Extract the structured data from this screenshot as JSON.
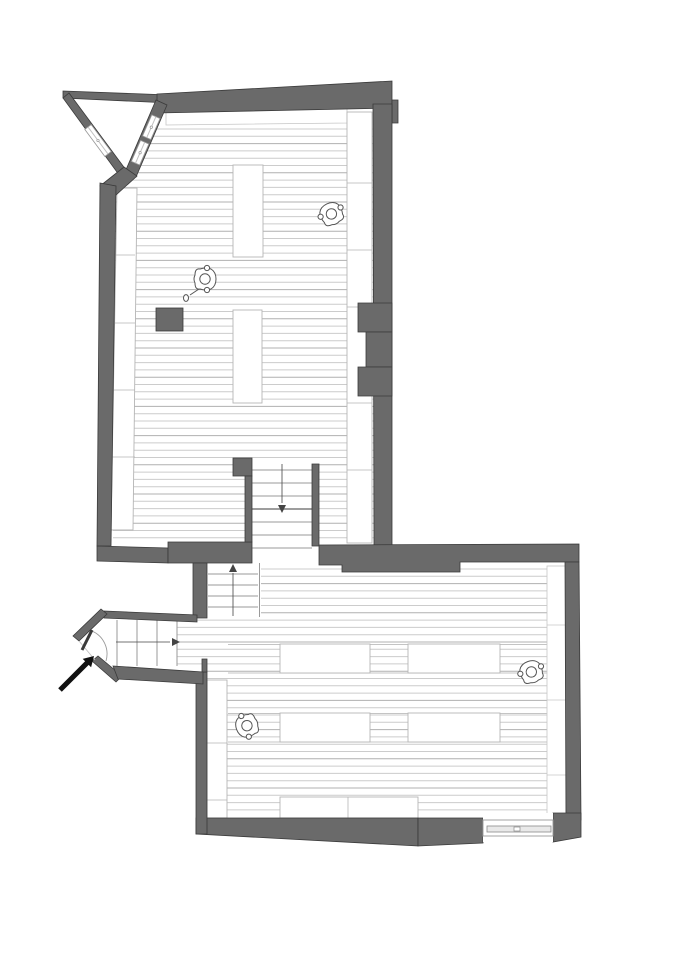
{
  "document": {
    "kind": "architectural floor plan drawing",
    "visible_text": "",
    "orientation": "plan view, two halls connected by staircases, entrance at lower left"
  },
  "canvas": {
    "width": 679,
    "height": 960,
    "background": "#ffffff"
  },
  "colors": {
    "wall_fill": "#6a6a6a",
    "wall_outline": "#3a3a3a",
    "board_line": "#cccccc",
    "board_line_dark": "#b0b0b0",
    "tread_line": "#9a9a9a",
    "tread_line_dark": "#7d7d7d",
    "walk_line": "#444444",
    "furniture_outline": "#b5b5b5",
    "figure_outline": "#555555",
    "arrow_black": "#111111",
    "window_frame": "#9a9a9a",
    "glass_fill": "#e9e9e9"
  },
  "floor_boards": {
    "upper_hall": {
      "x0": 106,
      "x1": 376,
      "y_start": 129,
      "y_end": 541,
      "spacing": 7.3
    },
    "lower_hall": {
      "x0": 172,
      "x1": 570,
      "y_start": 569,
      "y_end": 816,
      "spacing": 7.3
    }
  },
  "stairs": {
    "main": {
      "tread_x0": 252,
      "tread_x1": 312,
      "treads_y": [
        470,
        483,
        496,
        509,
        522,
        535,
        548
      ],
      "landing_line_y": 509,
      "walk_line": {
        "x": 282,
        "y0": 464,
        "y1": 503
      },
      "arrow": "down"
    },
    "small": {
      "tread_x0": 208,
      "tread_x1": 258,
      "treads_y": [
        574,
        585,
        596,
        607
      ],
      "side_line_x": 259.5,
      "side_line_y0": 563,
      "side_line_y1": 617,
      "walk_line": {
        "x": 233,
        "y0": 616,
        "y1": 573
      },
      "arrow": "up"
    },
    "entry": {
      "treads_x": [
        117,
        137,
        157
      ],
      "tread_y0": 620,
      "tread_y1": 666,
      "edge_line_x": 177,
      "walk_line": {
        "y": 642,
        "x0": 116,
        "x1": 170
      },
      "arrow": "right"
    }
  },
  "furniture": {
    "upper_tables": [
      {
        "x": 233,
        "y": 165,
        "w": 30,
        "h": 92
      },
      {
        "x": 233,
        "y": 310,
        "w": 29,
        "h": 93
      }
    ],
    "stove": {
      "x": 156,
      "y": 308,
      "w": 27,
      "h": 23
    },
    "upper_left_bench": {
      "points": "117,188 137,188 133,530 111,530",
      "dividers_y": [
        255,
        323,
        390,
        457
      ]
    },
    "upper_right_bench": {
      "x": 347,
      "y": 112,
      "w": 25,
      "h": 431,
      "dividers_y": [
        183,
        250,
        307,
        403,
        470
      ]
    },
    "upper_top_strip": {
      "points": "166,106 347,104 347,123 166,125"
    },
    "lower_tables": [
      {
        "x": 280,
        "y": 644,
        "w": 90,
        "h": 29
      },
      {
        "x": 408,
        "y": 644,
        "w": 92,
        "h": 29
      },
      {
        "x": 280,
        "y": 713,
        "w": 90,
        "h": 29
      },
      {
        "x": 408,
        "y": 713,
        "w": 92,
        "h": 29
      }
    ],
    "row_bands": [
      {
        "x0": 228,
        "x1": 547,
        "y0": 644.5,
        "y1": 673
      },
      {
        "x0": 228,
        "x1": 547,
        "y0": 713.5,
        "y1": 742
      }
    ],
    "lower_bottom_bench": {
      "x": 280,
      "y": 797,
      "w": 138,
      "h": 21,
      "divider_x": 348
    },
    "lower_left_bench": {
      "x": 207,
      "y": 680,
      "w": 20,
      "h": 138,
      "dividers_y": [
        743,
        800
      ]
    },
    "lower_right_strip": {
      "x": 547,
      "y": 566,
      "w": 19,
      "h": 250,
      "dividers_y": [
        625,
        700,
        775
      ]
    }
  },
  "figures": [
    {
      "x": 331,
      "y": 213,
      "rot": 155,
      "extended_arm": false
    },
    {
      "x": 206,
      "y": 279,
      "rot": -90,
      "extended_arm": true
    },
    {
      "x": 531,
      "y": 671,
      "rot": 160,
      "extended_arm": false
    },
    {
      "x": 246,
      "y": 726,
      "rot": 70,
      "extended_arm": false
    }
  ],
  "angled_windows": [
    {
      "points": "84.8,129.4 91.2,124.6 111.2,151.6 104.8,156.4",
      "line": [
        88,
        127,
        108,
        154
      ]
    },
    {
      "points": "160,118.5 151.8,114.9 142.6,135.9 150.8,139.5",
      "line": [
        155.9,
        116.7,
        146.7,
        137.7
      ]
    },
    {
      "points": "148.8,144 140.6,140.4 131.4,161.4 139.6,165",
      "line": [
        144.7,
        142.2,
        135.5,
        163.2
      ]
    }
  ],
  "bottom_window": {
    "frame": [
      483,
      820,
      553,
      836
    ],
    "glazing": [
      487,
      826,
      551,
      832
    ],
    "handle": [
      514,
      827,
      520,
      831
    ]
  },
  "entrance_door": {
    "leaf": [
      92,
      630,
      82,
      650
    ],
    "arc": "M92,631 A25,25 0 0 1 106,661",
    "threshold": [
      79,
      641,
      95,
      660
    ]
  },
  "entrance_arrow": {
    "points": "58.2,688.2 85.1,661.3 82.7,658.9 94,656 91.1,667.3 88.7,664.9 61.8,691.8"
  }
}
